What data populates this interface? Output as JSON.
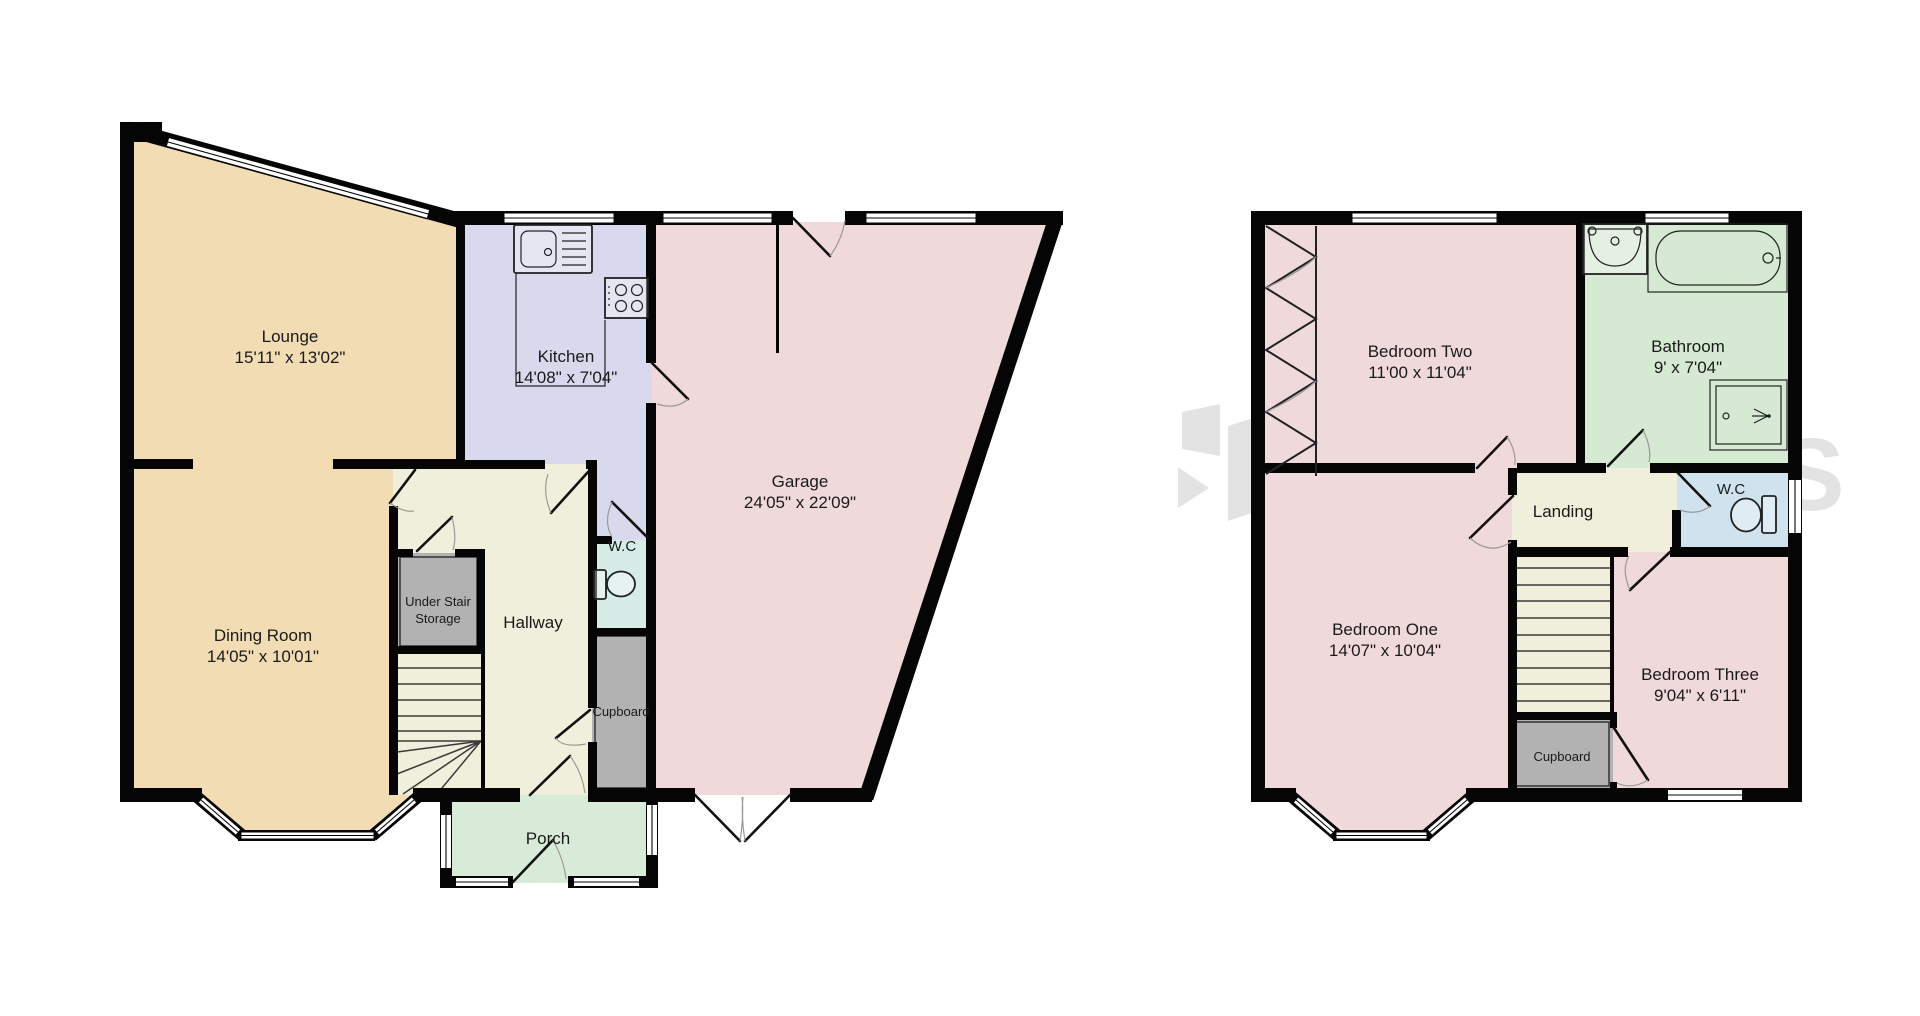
{
  "brand_watermark": "HORTONS",
  "colors": {
    "wall": "#050505",
    "lounge_dining_tan": "#f2dcb4",
    "kitchen_lavender": "#d9d9ed",
    "garage_bedroom_pink": "#efd9db",
    "hallway_landing_cream": "#f0efdb",
    "wc_ground_teal": "#d7ece7",
    "wc_first_blue": "#cfe2ee",
    "porch_green": "#d8ebd9",
    "bathroom_green": "#d6e9d3",
    "storage_gray": "#b2b2b2",
    "watermark_gray": "#000000"
  },
  "ground_floor": {
    "rooms": {
      "lounge": {
        "name": "Lounge",
        "dims": "15'11\" x 13'02\""
      },
      "kitchen": {
        "name": "Kitchen",
        "dims": "14'08\" x 7'04\""
      },
      "dining_room": {
        "name": "Dining Room",
        "dims": "14'05\" x 10'01\""
      },
      "garage": {
        "name": "Garage",
        "dims": "24'05\" x 22'09\""
      },
      "hallway": {
        "name": "Hallway"
      },
      "wc": {
        "name": "W.C"
      },
      "cupboard": {
        "name": "Cupboard"
      },
      "under_stair_storage": {
        "line1": "Under Stair",
        "line2": "Storage"
      },
      "porch": {
        "name": "Porch"
      }
    }
  },
  "first_floor": {
    "rooms": {
      "bedroom_one": {
        "name": "Bedroom One",
        "dims": "14'07\" x 10'04\""
      },
      "bedroom_two": {
        "name": "Bedroom Two",
        "dims": "11'00 x 11'04\""
      },
      "bedroom_three": {
        "name": "Bedroom Three",
        "dims": "9'04\" x 6'11\""
      },
      "bathroom": {
        "name": "Bathroom",
        "dims": "9' x 7'04\""
      },
      "landing": {
        "name": "Landing"
      },
      "wc": {
        "name": "W.C"
      },
      "cupboard": {
        "name": "Cupboard"
      }
    }
  }
}
